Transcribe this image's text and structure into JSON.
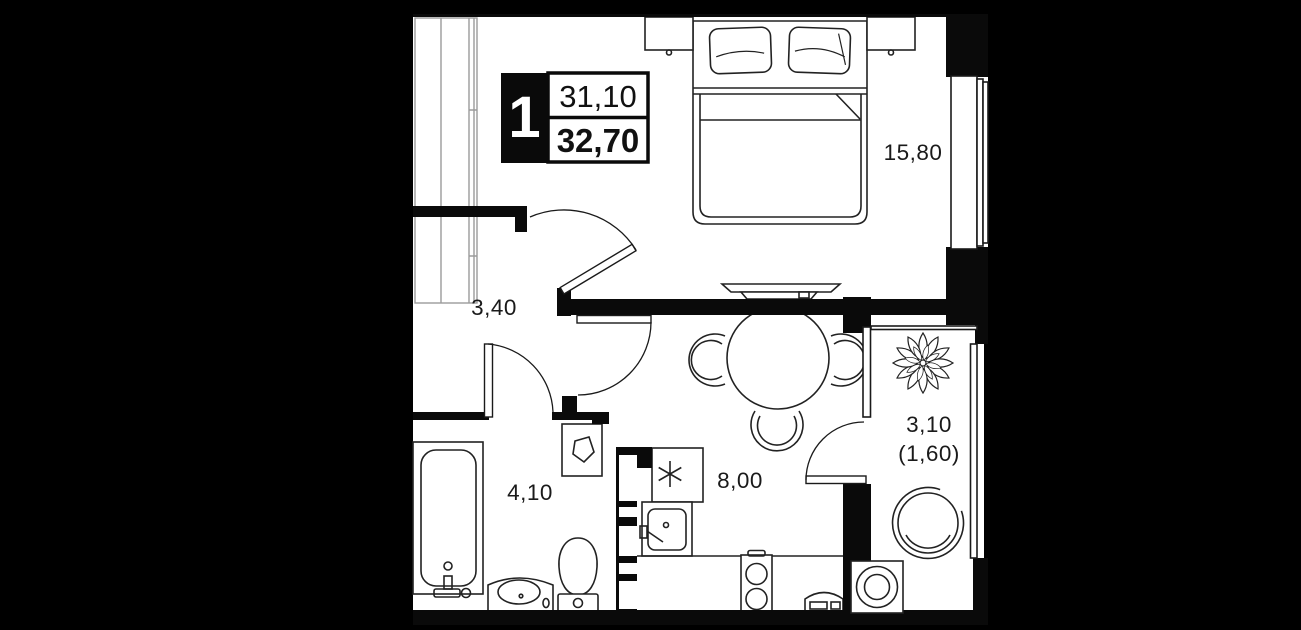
{
  "unit_card": {
    "rooms_count": "1",
    "area_top": "31,10",
    "area_bottom": "32,70"
  },
  "rooms": {
    "bedroom": {
      "area": "15,80"
    },
    "hallway": {
      "area": "3,40"
    },
    "bathroom": {
      "area": "4,10"
    },
    "kitchen": {
      "area": "8,00"
    },
    "balcony": {
      "area": "3,10",
      "area_coefficient": "(1,60)"
    }
  },
  "colors": {
    "background": "#000000",
    "floor": "#ffffff",
    "walls": "#0a0a0a",
    "furniture_line": "#222222",
    "text": "#1a1a1a",
    "badge_background": "#0a0a0a",
    "badge_text": "#ffffff"
  }
}
